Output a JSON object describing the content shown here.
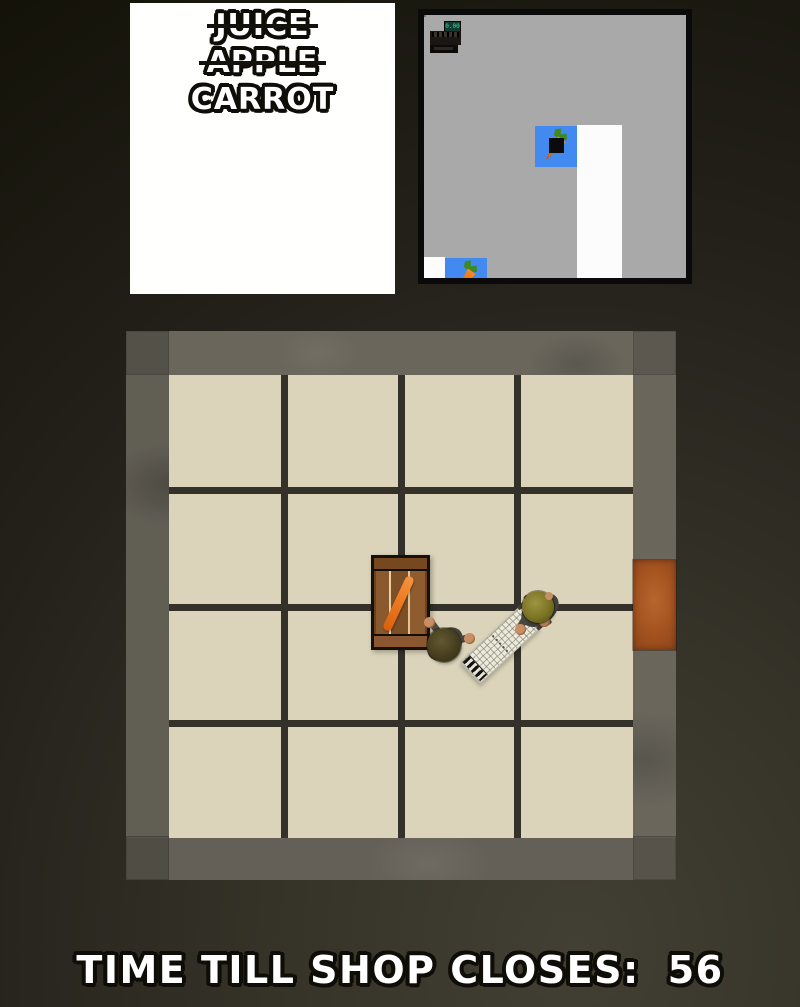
{
  "shopping_list": {
    "items": [
      {
        "label": "JUICE",
        "struck": true
      },
      {
        "label": "APPLE",
        "struck": true
      },
      {
        "label": "CARROT",
        "struck": false
      }
    ]
  },
  "minimap": {
    "register_display": "0.00",
    "icons": [
      "carrot-icon",
      "carrot-icon",
      "cash-register-icon",
      "player-marker"
    ]
  },
  "hud": {
    "timer_label": "TIME TILL SHOP CLOSES:",
    "timer_value": "56"
  },
  "colors": {
    "list_panel": "#fffffd",
    "minimap_floor": "#a9a9a9",
    "minimap_item_tile_blue": "#4289f0",
    "minimap_path_white": "#fcfcfc",
    "carrot_orange": "#ec7a22",
    "floor_tile": "#dbd4ba",
    "grout": "#34312a",
    "wall": "#6a665c",
    "door": "#a3521f",
    "background_dark": "#17160f",
    "hud_text": "#ffffff",
    "hud_outline": "#0f0d07"
  }
}
